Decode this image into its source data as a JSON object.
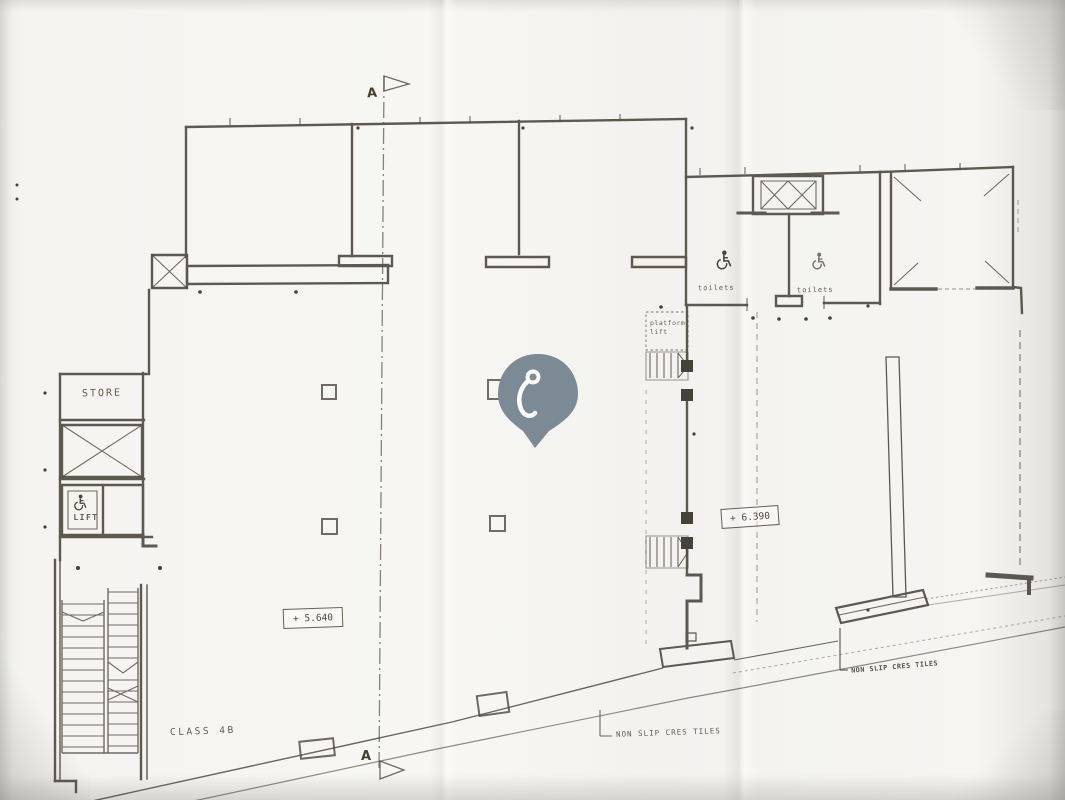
{
  "plan": {
    "section_markers": {
      "top": "A",
      "bottom": "A"
    },
    "rooms": {
      "store": "STORE",
      "lift": "LIFT",
      "classroom": "CLASS 4B",
      "toilets_left": "toilets",
      "toilets_right": "toilets",
      "platform_lift_line1": "platform",
      "platform_lift_line2": "lift"
    },
    "levels": {
      "main_hall": "+ 5.640",
      "upper_area": "+ 6.390"
    },
    "notes": {
      "non_slip_center": "NON SLIP CRES TILES",
      "non_slip_right": "NON SLIP CRES TILES"
    },
    "colors": {
      "ink": "#4e483c",
      "paper": "#f6f5f1"
    }
  },
  "pin": {
    "color": "#7b8a94",
    "icon": "hook-marker"
  }
}
